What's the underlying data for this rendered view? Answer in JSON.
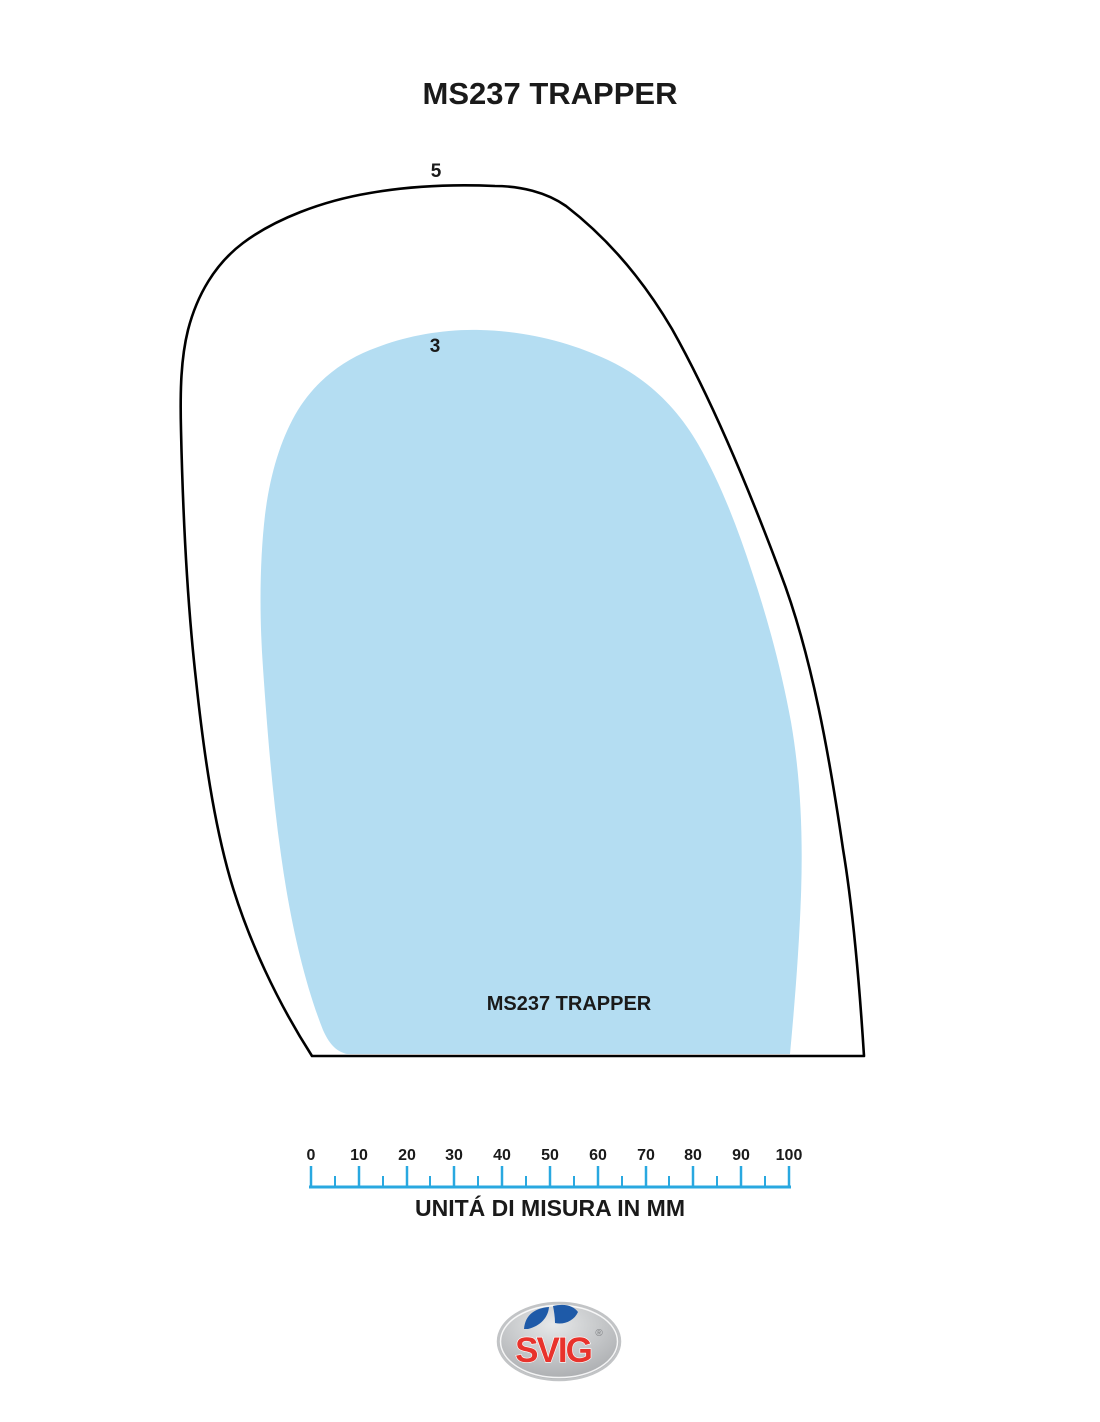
{
  "title": "MS237 TRAPPER",
  "diagram": {
    "outer_label": "5",
    "inner_label": "3",
    "inner_name": "MS237 TRAPPER",
    "fill_color": "#B4DDF2",
    "outline_color": "#000000"
  },
  "ruler": {
    "tick_labels": [
      "0",
      "10",
      "20",
      "30",
      "40",
      "50",
      "60",
      "70",
      "80",
      "90",
      "100"
    ],
    "caption": "UNITÁ DI MISURA IN MM",
    "color": "#29A8E0"
  },
  "logo": {
    "text": "SVIG",
    "registered": "®",
    "text_color": "#E8332C",
    "bird_color": "#1E5AA8"
  }
}
